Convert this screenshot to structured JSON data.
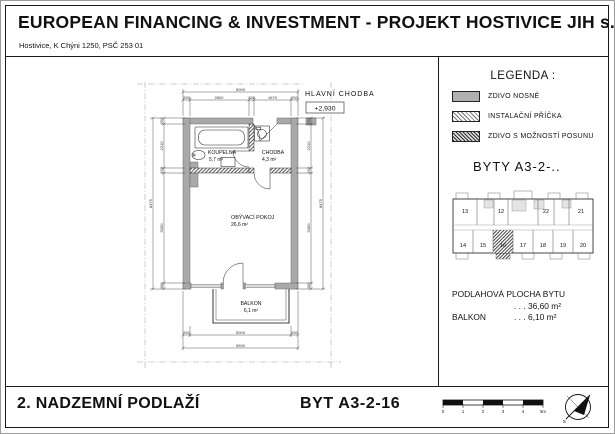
{
  "header": {
    "title": "EUROPEAN FINANCING & INVESTMENT - PROJEKT HOSTIVICE JIH s.r.o.",
    "address": "Hostivice, K Chýni 1250, PSČ 253 01"
  },
  "legend": {
    "title": "LEGENDA :",
    "items": [
      {
        "label": "ZDIVO NOSNÉ",
        "swatch": "solid-gray"
      },
      {
        "label": "INSTALAČNÍ PŘÍČKA",
        "swatch": "hatch-light"
      },
      {
        "label": "ZDIVO S MOŽNOSTÍ POSUNU",
        "swatch": "hatch-dark"
      }
    ]
  },
  "unit_series_label": "BYTY  A3-2-..",
  "key_plan": {
    "top_units": [
      "13",
      "12",
      "22",
      "21"
    ],
    "bottom_units": [
      "14",
      "15",
      "16",
      "17",
      "18",
      "19",
      "20"
    ],
    "highlighted_unit": "16"
  },
  "areas": {
    "floor_label": "PODLAHOVÁ PLOCHA BYTU",
    "floor_value": ". . .  36,60 m²",
    "balcony_label": "BALKON",
    "balcony_value": ". . .  6,10 m²"
  },
  "plan": {
    "corridor_label": "HLAVNÍ CHODBA",
    "level_mark": "+2,930",
    "rooms": {
      "bathroom": {
        "name": "KOUPELNA",
        "area": "5,7 m²"
      },
      "hall": {
        "name": "CHODBA",
        "area": "4,3 m²"
      },
      "living": {
        "name": "OBÝVACÍ POKOJ",
        "area": "26,6 m²"
      },
      "balcony": {
        "name": "BALKON",
        "area": "6,1 m²"
      }
    },
    "dims": {
      "top_total": "5000",
      "top_seg": [
        "250",
        "2800",
        "150",
        "1670",
        "250"
      ],
      "bottom_inner": [
        "250",
        "5000",
        "250"
      ],
      "bottom_total": "5500",
      "left_total": "8475",
      "left_seg": [
        "250",
        "2210",
        "150",
        "5090",
        "400"
      ],
      "right_total": "8475",
      "right_seg": [
        "250",
        "2210",
        "150",
        "5060",
        "400"
      ]
    }
  },
  "footer": {
    "floor_title": "2. NADZEMNÍ PODLAŽÍ",
    "unit_title": "BYT  A3-2-16",
    "scale_ticks": [
      "0",
      "1",
      "2",
      "3",
      "4",
      "5m"
    ],
    "north_label": "s"
  },
  "colors": {
    "wall_fill": "#a9a9a9",
    "line": "#1a1a1a"
  }
}
